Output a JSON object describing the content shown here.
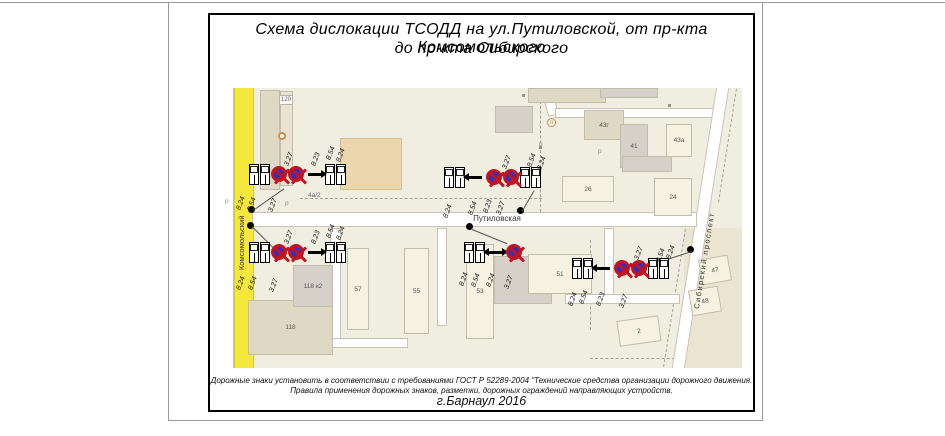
{
  "page": {
    "title_line1": "Схема дислокации ТСОДД на ул.Путиловской, от пр-кта Комсомольского",
    "title_line2": "до пр-кта Сибирского",
    "footer_line1": "Дорожные знаки установить в соответствии с требованиями ГОСТ Р 52289-2004 \"Технические средства организации дорожного движения.",
    "footer_line2": "Правила применения дорожных знаков, разметки, дорожных  ограждений направляющих устройств.",
    "footer_city_year": "г.Барнаул 2016"
  },
  "map": {
    "streets": {
      "putilovskaya": "Путиловская",
      "komsomolsky": "Комсомольский",
      "sibirsky": "Сибирский проспект"
    },
    "buildings": [
      {
        "label": "120"
      },
      {
        "label": "4а/2"
      },
      {
        "label": "43г"
      },
      {
        "label": "41"
      },
      {
        "label": "43а"
      },
      {
        "label": "26"
      },
      {
        "label": "24"
      },
      {
        "label": "118 к2"
      },
      {
        "label": "118"
      },
      {
        "label": "57"
      },
      {
        "label": "55"
      },
      {
        "label": "53"
      },
      {
        "label": "51"
      },
      {
        "label": "47"
      },
      {
        "label": "48"
      },
      {
        "label": "2"
      }
    ],
    "parking_marks": [
      "р",
      "р",
      "р",
      "р"
    ],
    "poi_p": "п",
    "sign_groups": [
      {
        "id": "g1",
        "labels_above": [
          "3.27",
          "8.23",
          "8.54",
          "8.24"
        ],
        "labels_below": [
          "8.24",
          "8.54",
          "3.27"
        ]
      },
      {
        "id": "g2",
        "labels_above": [
          "3.27",
          "8.54",
          "8.24"
        ],
        "labels_below": [
          "8.24",
          "8.54",
          "8.23",
          "3.27"
        ]
      },
      {
        "id": "g3",
        "labels_above": [
          "3.27",
          "8.23",
          "8.54",
          "8.24"
        ],
        "labels_below": [
          "8.24",
          "8.54",
          "3.27"
        ]
      },
      {
        "id": "g4",
        "labels_above": [],
        "labels_below": [
          "8.24",
          "8.54",
          "8.24",
          "3.27"
        ]
      },
      {
        "id": "g5",
        "labels_above": [
          "3.27",
          "8.54",
          "8.24"
        ],
        "labels_below": [
          "8.24",
          "8.54",
          "8.23",
          "3.27"
        ]
      }
    ],
    "colors": {
      "map_bg": "#f0ede1",
      "road_yellow": "#f5e73c",
      "building_cream": "#f6f2e1",
      "building_gray": "#d6d1c8",
      "building_tan": "#ecd7ad",
      "sign_ring_red": "#c41320",
      "sign_fill_blue": "#2633cb"
    }
  }
}
